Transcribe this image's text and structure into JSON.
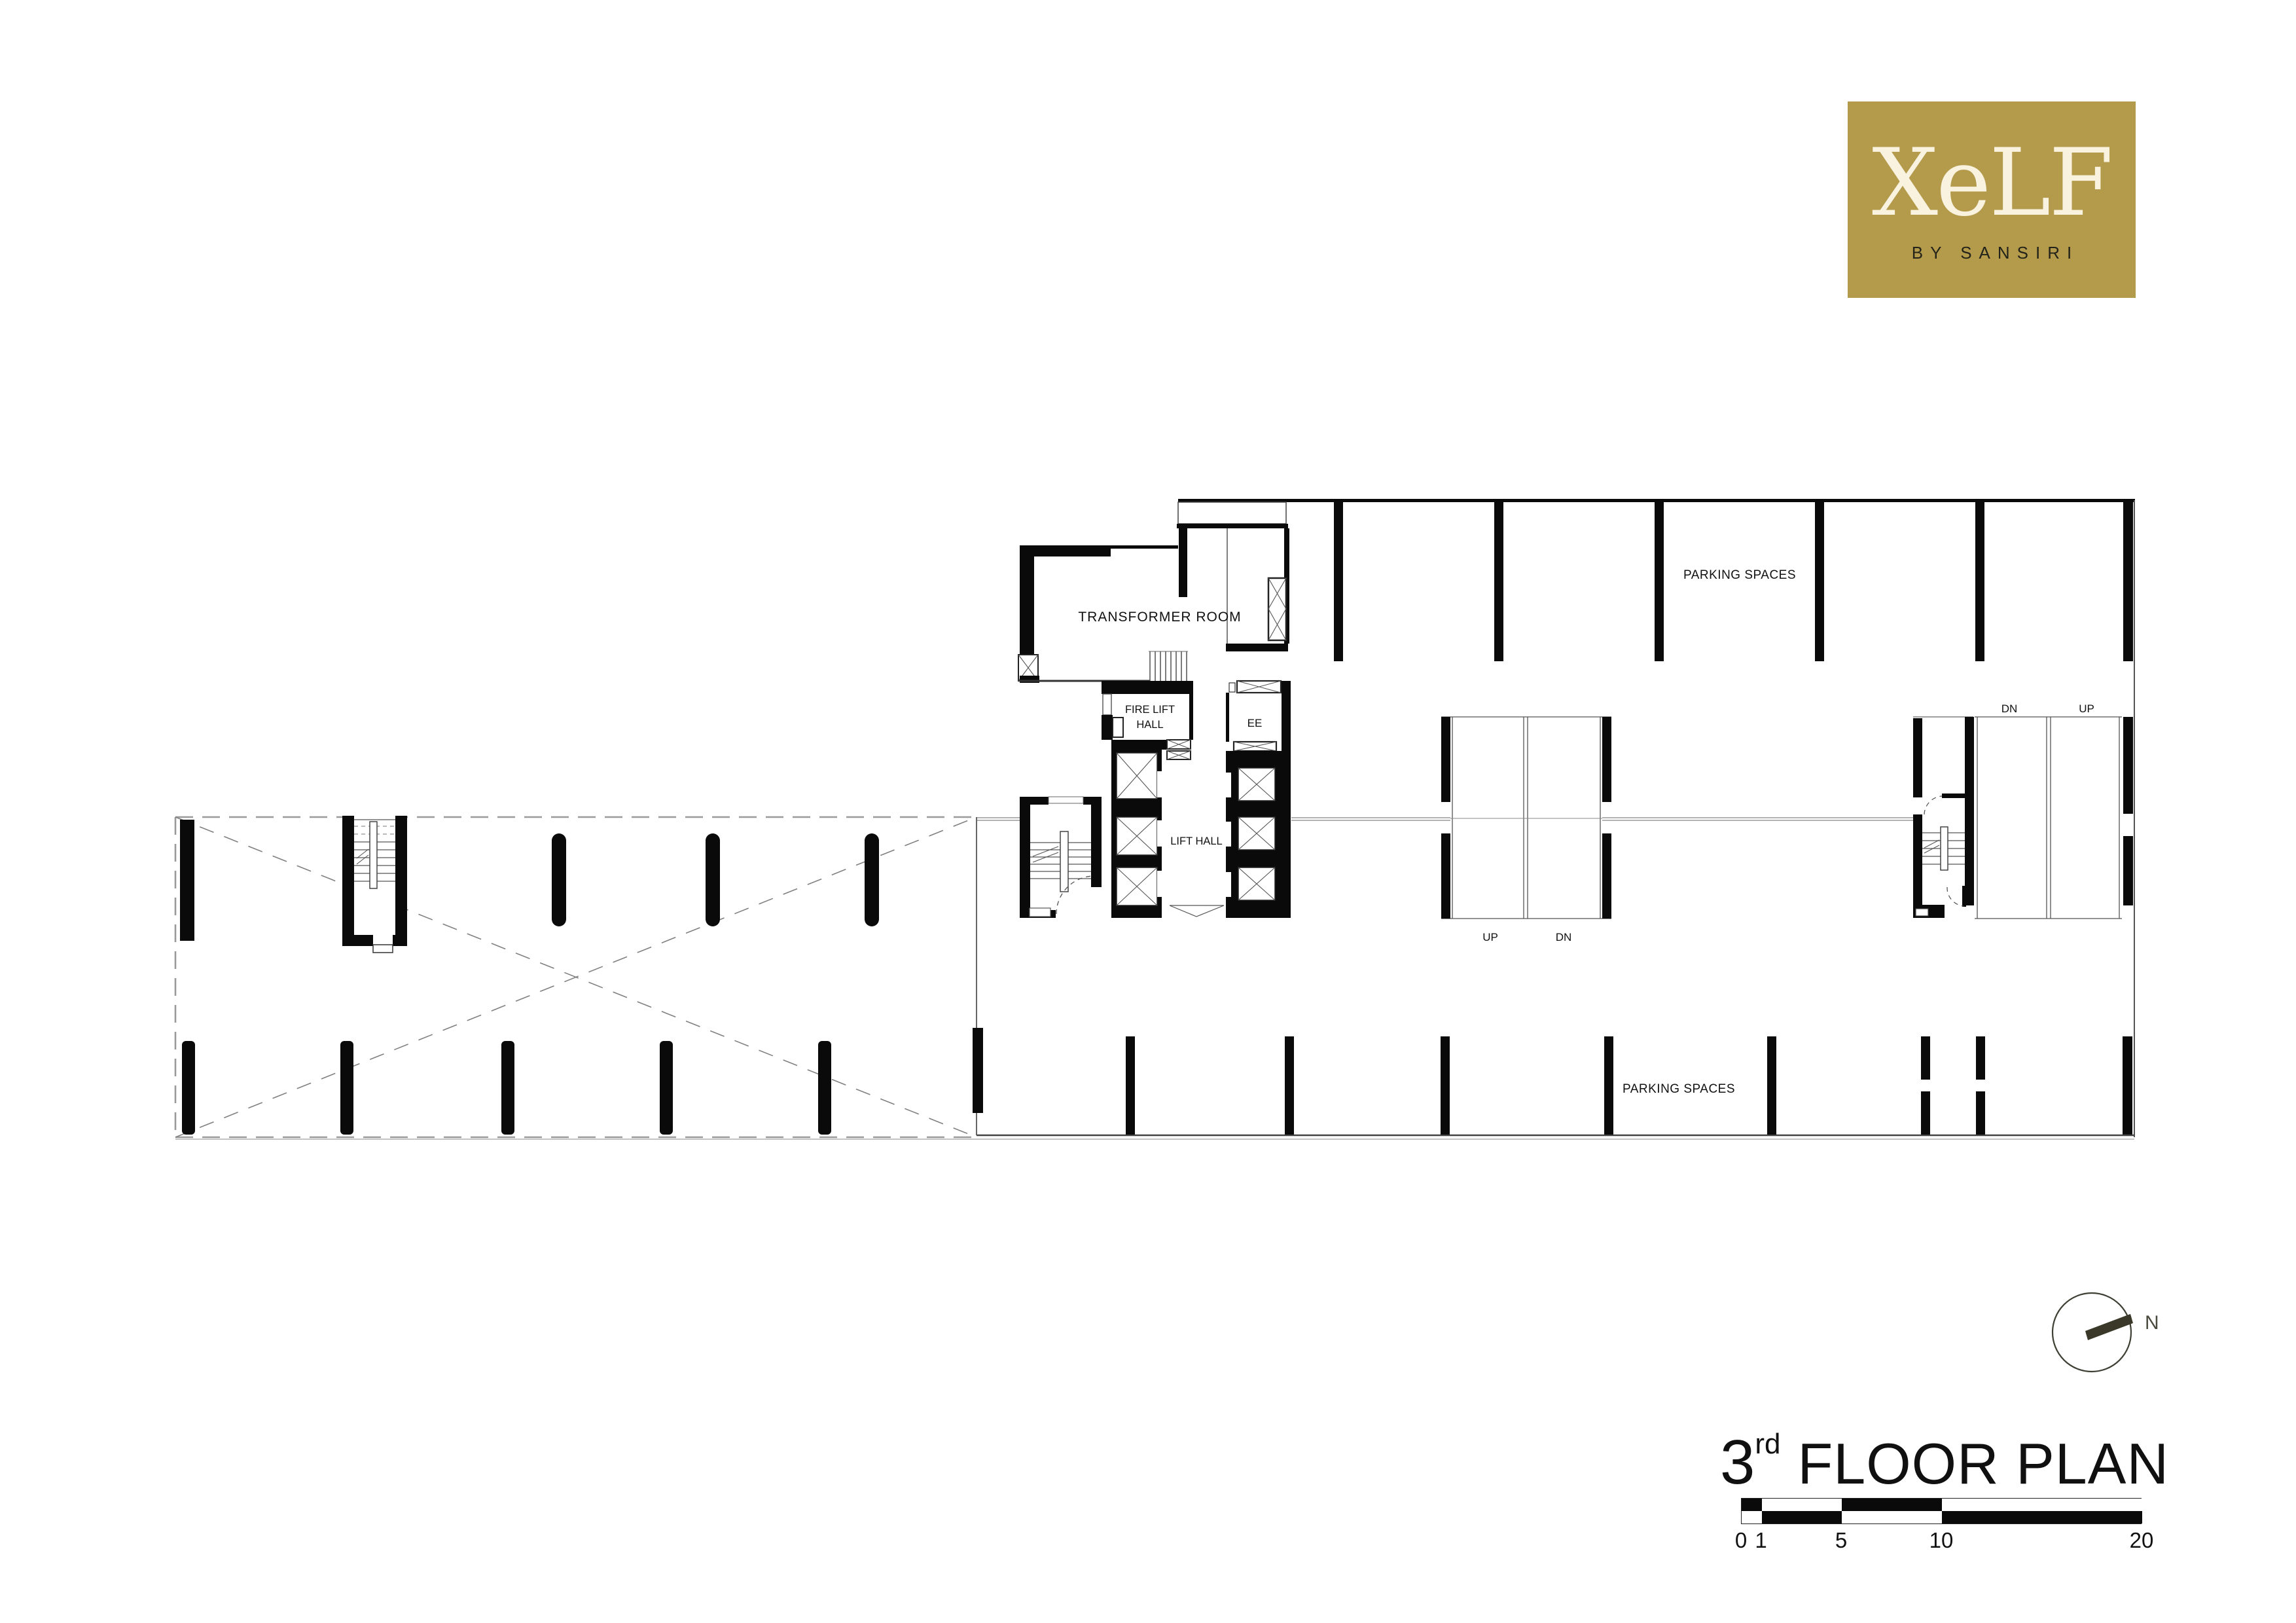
{
  "logo": {
    "brand": "XeLF",
    "subtitle": "BY SANSIRI",
    "bg_color": "#b49b4c",
    "brand_color": "#f8f2df",
    "subtitle_color": "#23231a"
  },
  "title": {
    "floor_number": "3",
    "ordinal": "rd",
    "text": "FLOOR PLAN"
  },
  "north": {
    "label": "N"
  },
  "scale_bar": {
    "labels": [
      "0",
      "1",
      "5",
      "10",
      "20"
    ],
    "units": [
      0,
      1,
      5,
      10,
      20
    ]
  },
  "plan": {
    "labels": {
      "transformer_room": "TRANSFORMER ROOM",
      "fire_lift_hall_line1": "FIRE LIFT",
      "fire_lift_hall_line2": "HALL",
      "ee": "EE",
      "lift_hall": "LIFT HALL",
      "parking_top": "PARKING SPACES",
      "parking_bottom": "PARKING SPACES",
      "ramp_center_up": "UP",
      "ramp_center_dn": "DN",
      "ramp_right_dn": "DN",
      "ramp_right_up": "UP"
    }
  },
  "colors": {
    "ink": "#000000",
    "wall": "#0a0a0a",
    "thin_line": "#444444",
    "dash_line": "#999999",
    "gold": "#b49b4c",
    "needle": "#3a3828"
  }
}
